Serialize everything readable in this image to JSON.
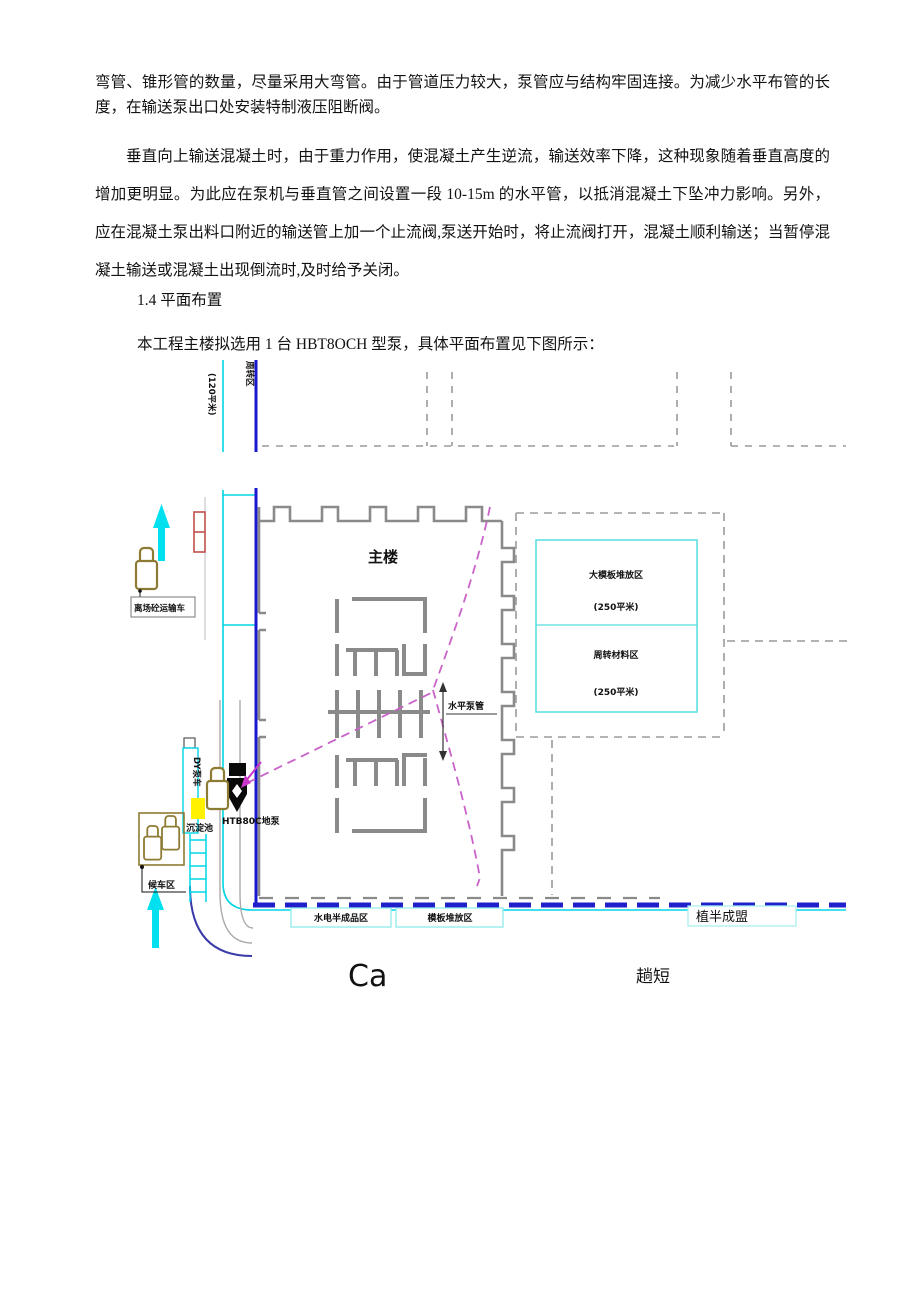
{
  "page": {
    "paragraph1": "弯管、锥形管的数量，尽量采用大弯管。由于管道压力较大，泵管应与结构牢固连接。为减少水平布管的长度，在输送泵出口处安装特制液压阻断阀。",
    "paragraph2": "垂直向上输送混凝土时，由于重力作用，使混凝土产生逆流，输送效率下降，这种现象随着垂直高度的增加更明显。为此应在泵机与垂直管之间设置一段 10-15m 的水平管，以抵消混凝土下坠冲力影响。另外，应在混凝土泵出料口附近的输送管上加一个止流阀,泵送开始时，将止流阀打开，混凝土顺利输送；当暂停混凝土输送或混凝土出现倒流时,及时给予关闭。",
    "heading": "1.4  平面布置",
    "paragraph3": "本工程主楼拟选用 1 台 HBT8OCH 型泵，具体平面布置见下图所示："
  },
  "diagram": {
    "labels": {
      "area_120": "(120平米)",
      "turnover_zone": "周转区",
      "main_building": "主楼",
      "leaving_truck": "离场砼运输车",
      "pump_truck_lane": "DY泵车",
      "sediment_pool": "沉淀池",
      "pump_unit": "HTB80C地泵",
      "waiting_area": "候车区",
      "horizontal_pipe": "水平泵管",
      "formwork_zone_title": "大模板堆放区",
      "formwork_zone_area": "(250平米)",
      "turnover_material_title": "周转材料区",
      "turnover_material_area": "(250平米)",
      "hydropower_zone": "水电半成品区",
      "formwork_stack_zone": "模板堆放区",
      "right_note": "植半成盟",
      "caption_ca": "Ca",
      "caption_right": "趟短"
    },
    "colors": {
      "boundary_blue": "#1818ce",
      "cyan": "#00d5e5",
      "cyan_light": "#8feaea",
      "building_gray": "#8a8a8a",
      "dashed_gray": "#9a9a9a",
      "pipe_magenta": "#c963c9",
      "truck_olive": "#8e7b33",
      "pool_yellow": "#fff100",
      "gate_red": "#c0504d",
      "caption_olive": "#a58d2f"
    }
  }
}
